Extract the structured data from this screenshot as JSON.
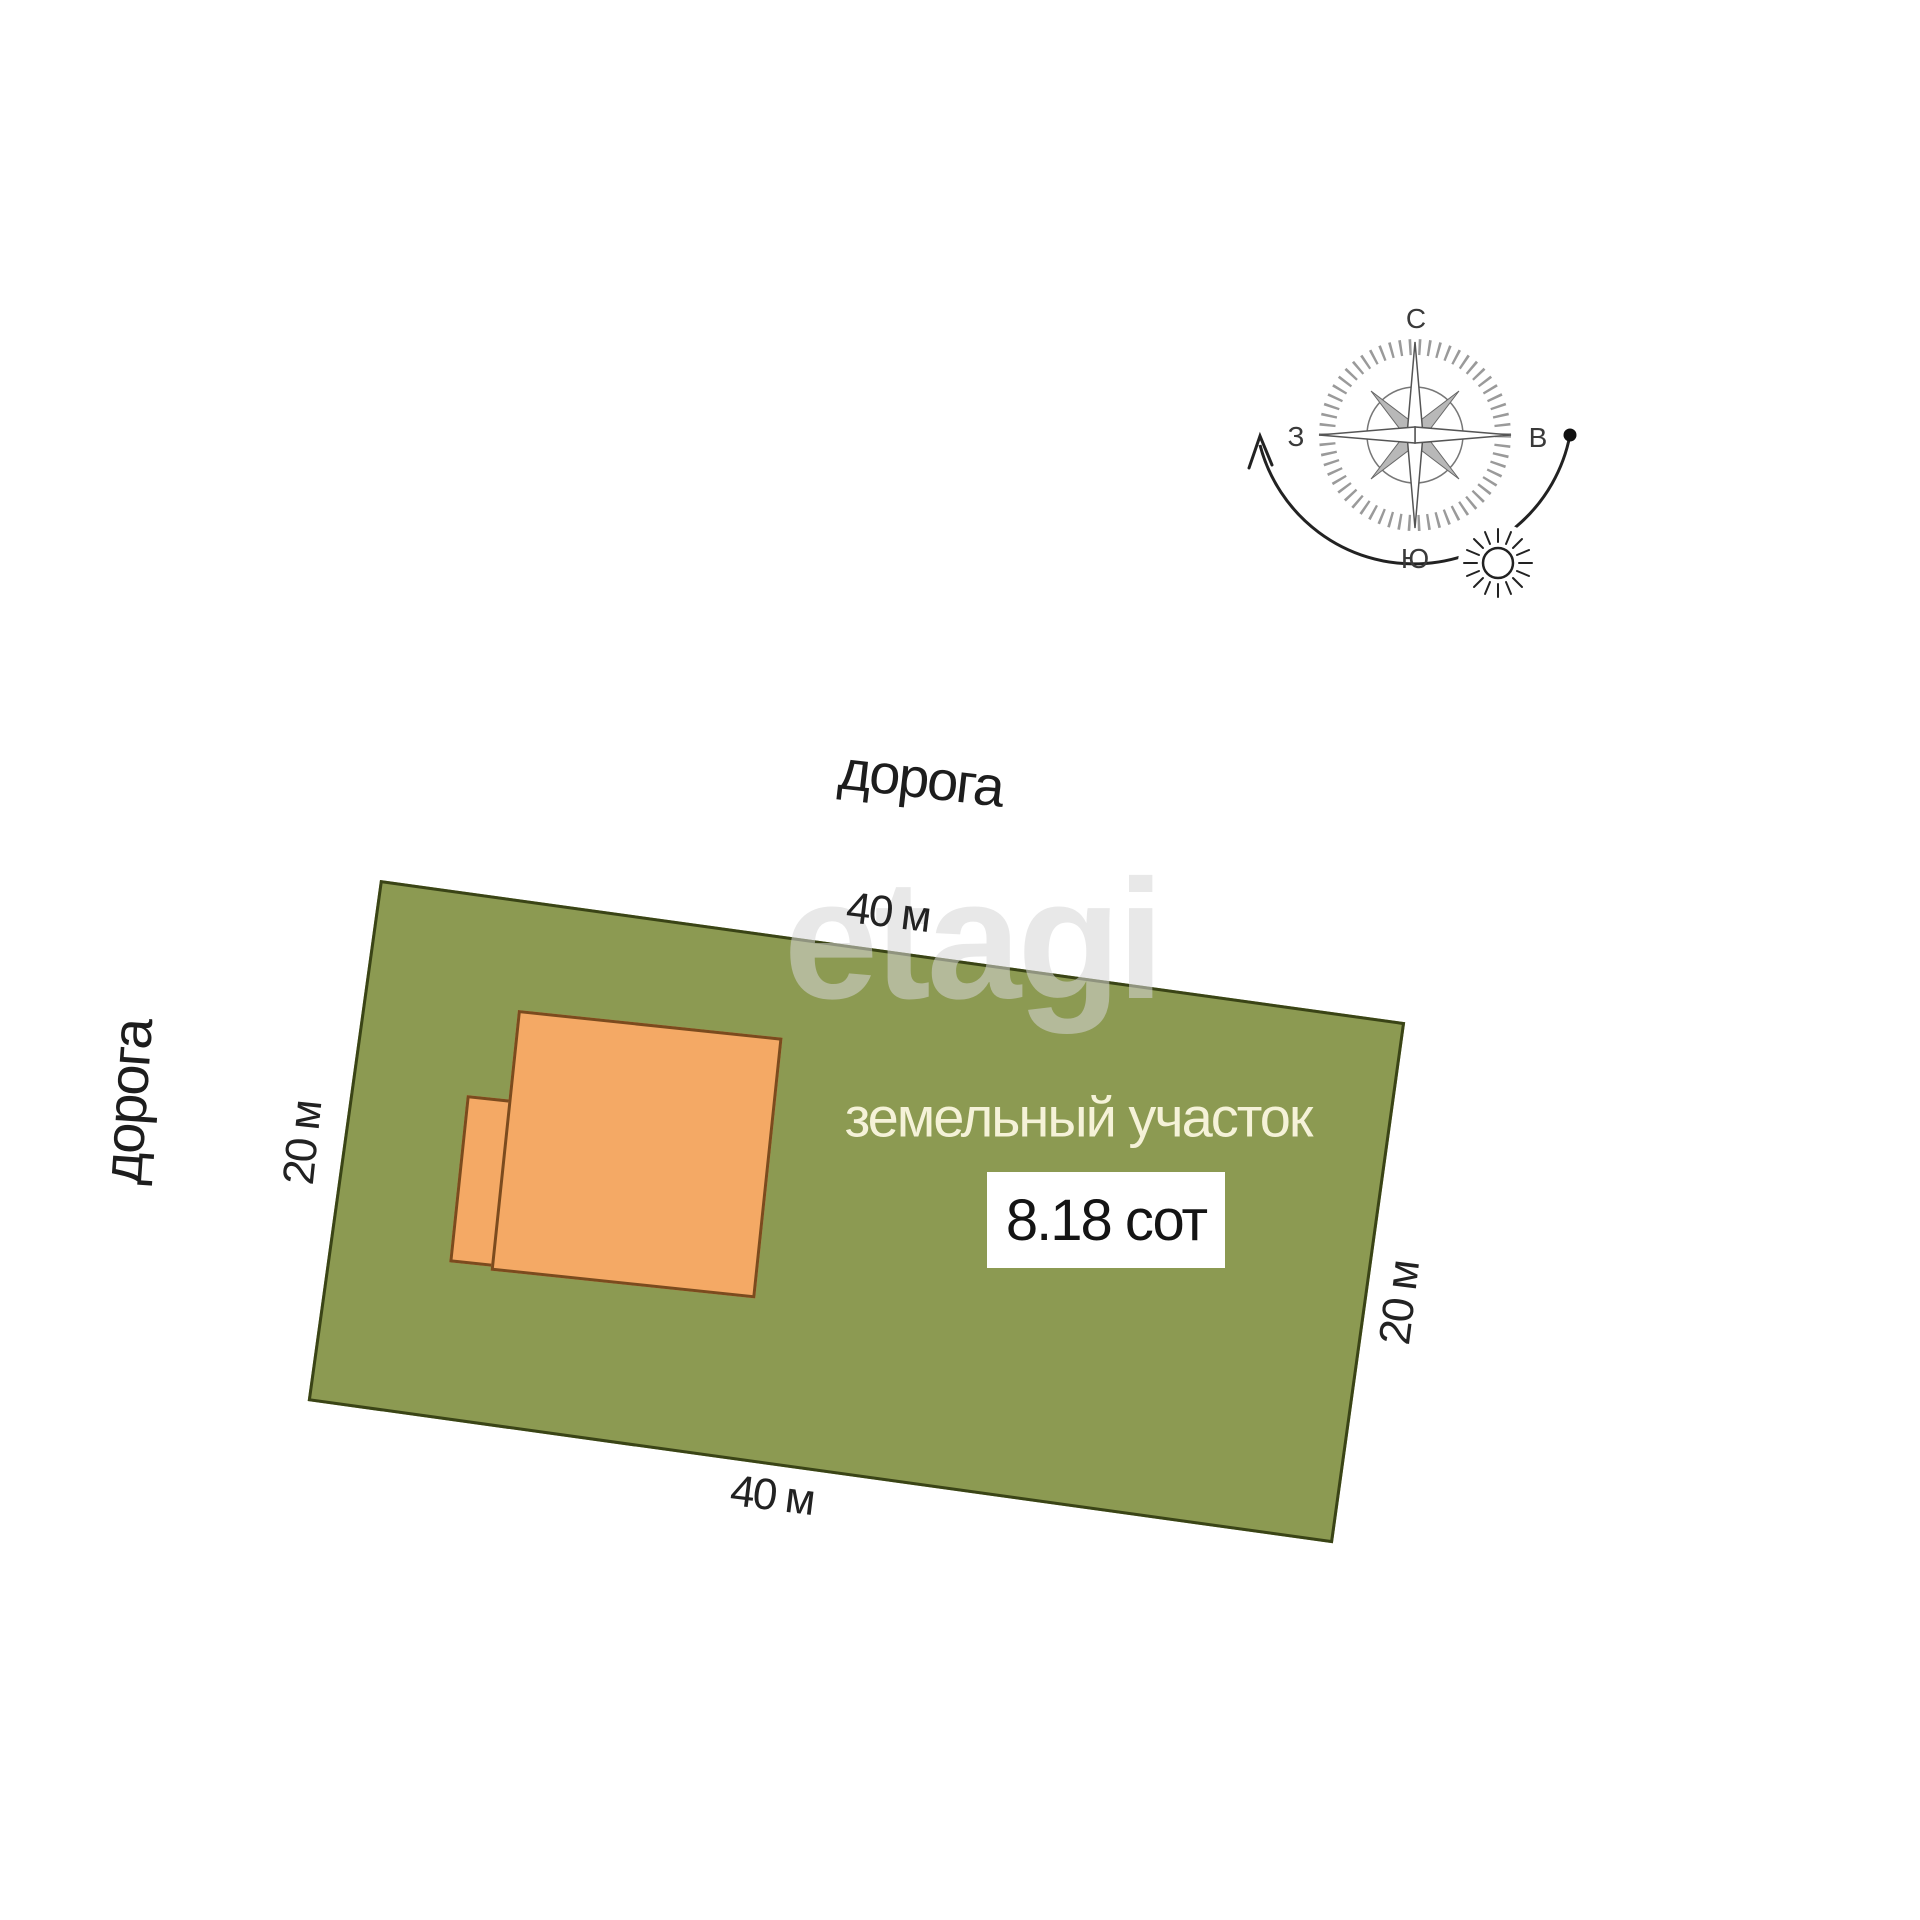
{
  "roads": {
    "top_label": "дорога",
    "left_label": "дорога"
  },
  "plot": {
    "label": "земельный участок",
    "area_label": "8.18 сот",
    "dim_top": "40 м",
    "dim_bottom": "40 м",
    "dim_left": "20 м",
    "dim_right": "20 м",
    "fill": "#8C9A52",
    "border_color": "#3A4416",
    "label_color": "#F5F2D8"
  },
  "building": {
    "fill": "#F4A965",
    "border_color": "#7B4B1E"
  },
  "compass": {
    "north_label": "С",
    "east_label": "В",
    "south_label": "Ю",
    "west_label": "З"
  },
  "watermark": {
    "text": "etagi",
    "color": "rgba(214,214,214,0.55)"
  }
}
